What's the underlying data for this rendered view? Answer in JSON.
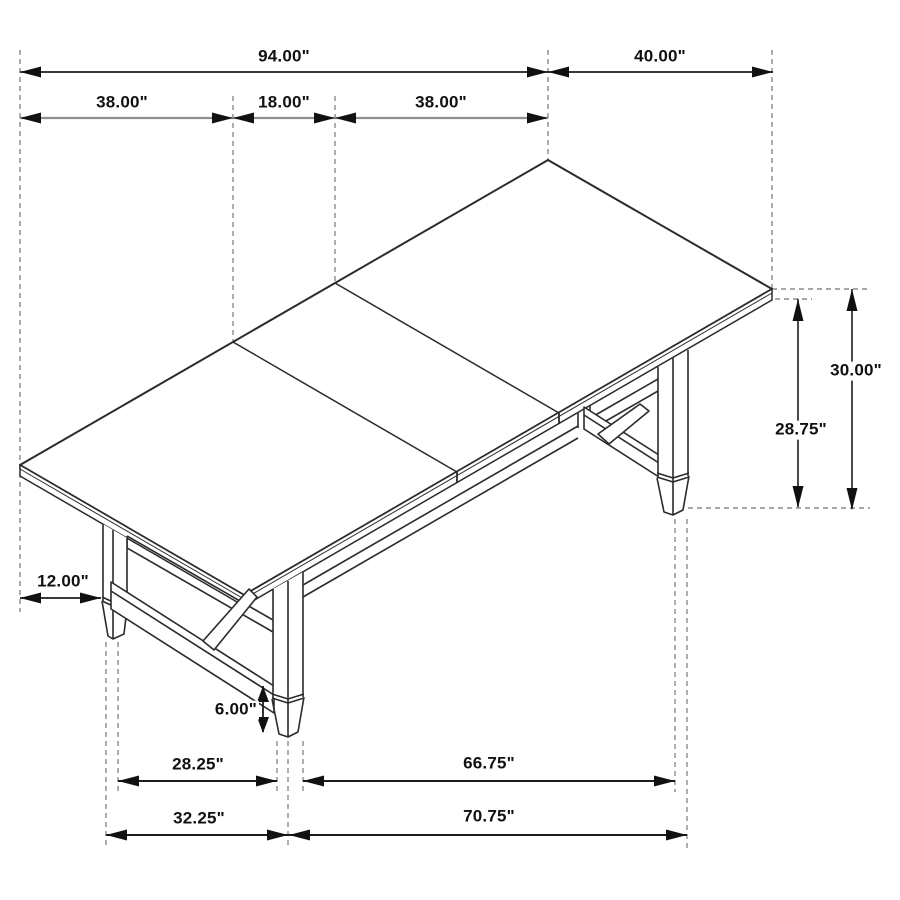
{
  "diagram": {
    "name": "dining-table-dimension-diagram",
    "style": "isometric line drawing with dimension arrows",
    "unit": "inches",
    "background_color": "#ffffff",
    "colors": {
      "primary_line": "#1c1c1c",
      "drawing_line": "#2b2b2b",
      "secondary_dim_line": "#8f8f8f",
      "dashed_line": "#8c8c8c",
      "label_text": "#111111",
      "label_background": "#ffffff"
    },
    "labels": {
      "overall_length": "94.00\"",
      "overall_depth": "40.00\"",
      "left_panel": "38.00\"",
      "center_leaf": "18.00\"",
      "right_panel": "38.00\"",
      "table_height": "30.00\"",
      "underside_clearance": "28.75\"",
      "end_overhang": "12.00\"",
      "foot_height": "6.00\"",
      "feet_inner_depth": "28.25\"",
      "feet_inner_length": "66.75\"",
      "feet_outer_depth": "32.25\"",
      "feet_outer_length": "70.75\""
    },
    "measurements": [
      {
        "name": "overall tabletop length",
        "value_in": 94.0
      },
      {
        "name": "overall tabletop depth",
        "value_in": 40.0
      },
      {
        "name": "left tabletop panel",
        "value_in": 38.0
      },
      {
        "name": "center extension leaf",
        "value_in": 18.0
      },
      {
        "name": "right tabletop panel",
        "value_in": 38.0
      },
      {
        "name": "table height",
        "value_in": 30.0
      },
      {
        "name": "floor to tabletop underside",
        "value_in": 28.75
      },
      {
        "name": "tabletop end overhang",
        "value_in": 12.0
      },
      {
        "name": "foot height",
        "value_in": 6.0
      },
      {
        "name": "between feet (depth, inner)",
        "value_in": 28.25
      },
      {
        "name": "between feet (length, inner)",
        "value_in": 66.75
      },
      {
        "name": "feet outer span (depth)",
        "value_in": 32.25
      },
      {
        "name": "feet outer span (length)",
        "value_in": 70.75
      }
    ]
  }
}
